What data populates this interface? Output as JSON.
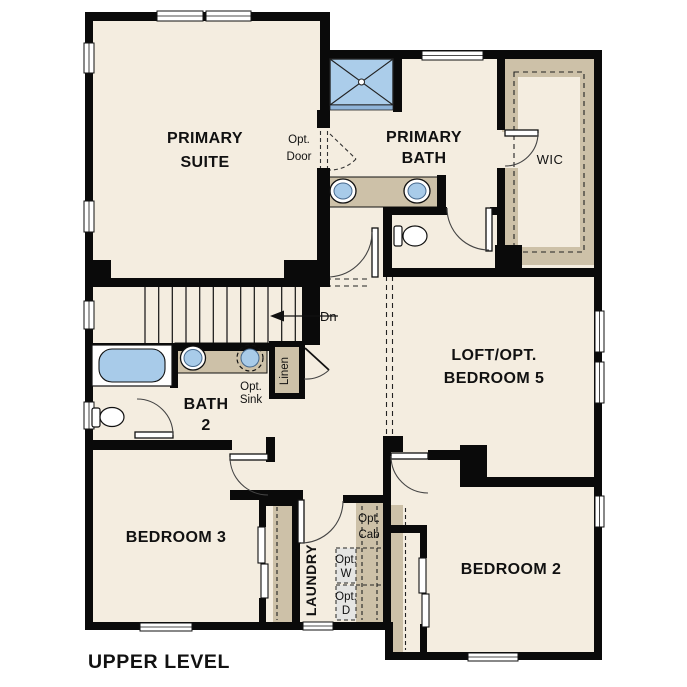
{
  "title": "UPPER LEVEL",
  "colors": {
    "wall": "#0a0a0a",
    "floor": "#f4ede0",
    "counter_tan": "#cdc1a8",
    "fixture_blue": "#a8cbe9",
    "shower_blue": "#abcdea",
    "optional_gray": "#e5e5e3",
    "door_arc": "#444444"
  },
  "rooms": {
    "primary_suite": {
      "line1": "PRIMARY",
      "line2": "SUITE"
    },
    "primary_bath": {
      "line1": "PRIMARY",
      "line2": "BATH"
    },
    "wic": {
      "label": "WIC"
    },
    "loft": {
      "line1": "LOFT/OPT.",
      "line2": "BEDROOM 5"
    },
    "bath2": {
      "line1": "BATH",
      "line2": "2"
    },
    "bedroom3": {
      "label": "BEDROOM 3"
    },
    "bedroom2": {
      "label": "BEDROOM 2"
    },
    "laundry": {
      "label": "LAUNDRY"
    },
    "linen": {
      "label": "Linen"
    }
  },
  "annotations": {
    "opt_door": {
      "line1": "Opt.",
      "line2": "Door"
    },
    "opt_sink": {
      "line1": "Opt.",
      "line2": "Sink"
    },
    "opt_cab": {
      "line1": "Opt.",
      "line2": "Cab"
    },
    "opt_washer": {
      "line1": "Opt.",
      "line2": "W"
    },
    "opt_dryer": {
      "line1": "Opt.",
      "line2": "D"
    },
    "stairs_down": {
      "label": "Dn"
    }
  }
}
